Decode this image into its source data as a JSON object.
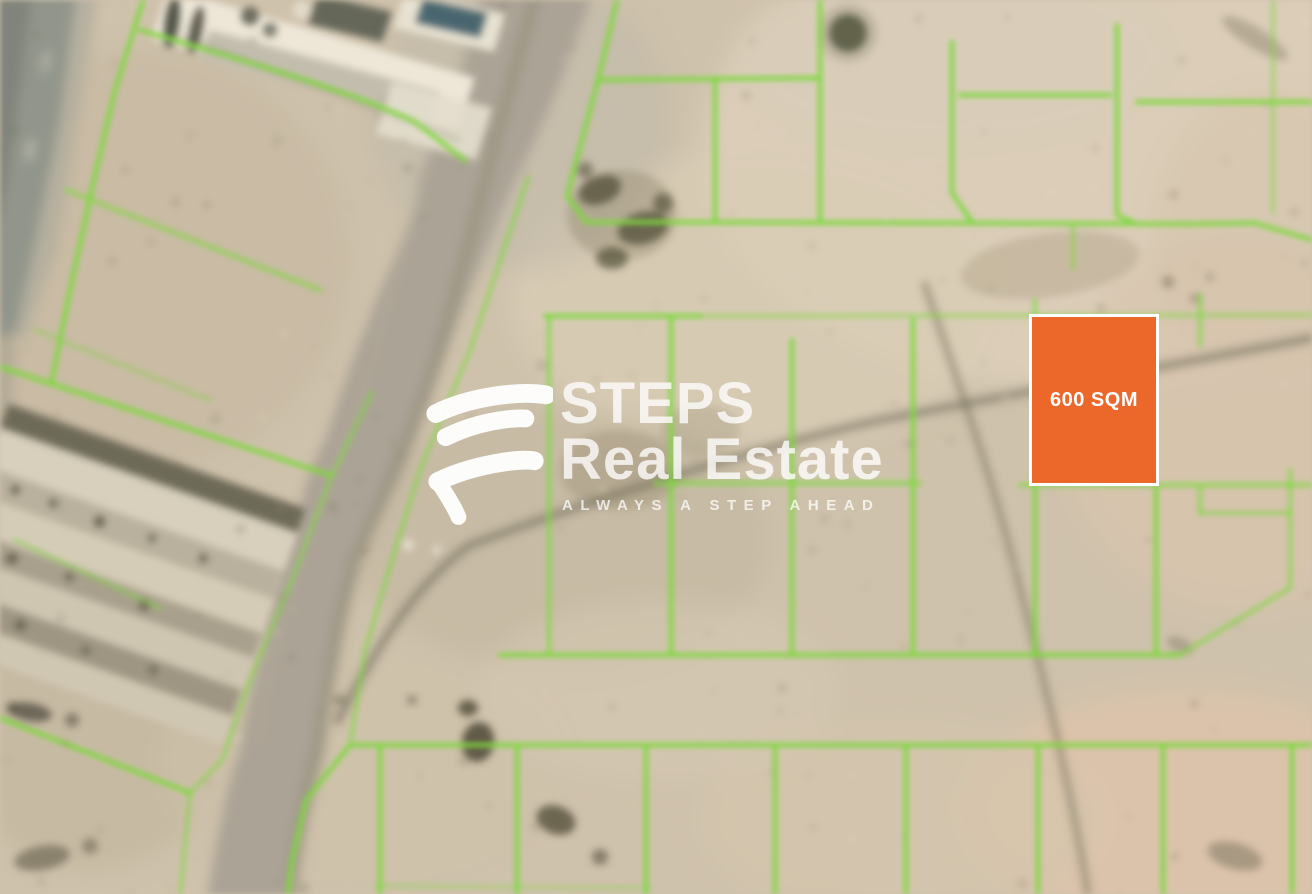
{
  "brand": {
    "logo_icon": "steps-logo-icon",
    "name_line1": "STEPS",
    "name_line2": "Real Estate",
    "tagline": "ALWAYS A STEP AHEAD",
    "watermark_color": "#ffffff"
  },
  "highlighted_plot": {
    "label": "600 SQM",
    "fill_color": "#ec672a",
    "border_color": "#ffffff",
    "text_color": "#ffffff"
  },
  "map": {
    "type": "blurred satellite aerial view of desert land plots",
    "plot_boundary_color": "#7fd83f",
    "terrain_base_color": "#cfc2ac"
  }
}
